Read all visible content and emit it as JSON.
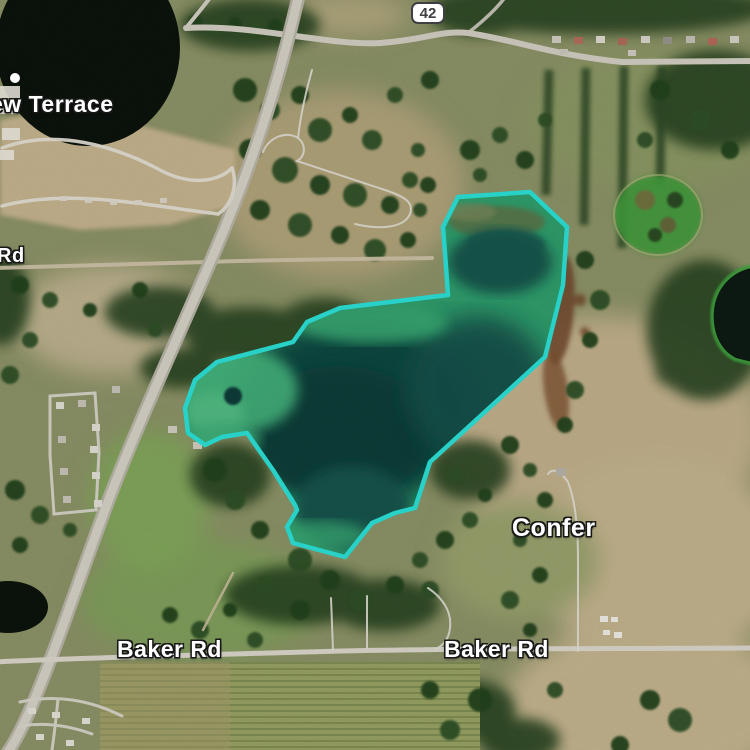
{
  "map": {
    "route_shield": {
      "number": "42"
    },
    "labels": [
      {
        "id": "place-terrace",
        "text": "ew Terrace"
      },
      {
        "id": "road-rd",
        "text": "Rd"
      },
      {
        "id": "locality-confer",
        "text": "Confer"
      },
      {
        "id": "road-baker-west",
        "text": "Baker Rd"
      },
      {
        "id": "road-baker-east",
        "text": "Baker Rd"
      }
    ],
    "selection": {
      "feature": "lake-parcel",
      "outline_color": "#2BDED4"
    },
    "colors": {
      "lake_deep": "#0E3C39",
      "lake_shallow": "#3FAE7C",
      "dark_pond": "#0C140D",
      "label_text": "#FFFFFF",
      "road": "#D3CFC4",
      "shield_background": "#FFFFFF",
      "shield_border": "#3E3F42"
    },
    "markers": [
      {
        "id": "poi-dot",
        "type": "white-dot"
      }
    ]
  }
}
